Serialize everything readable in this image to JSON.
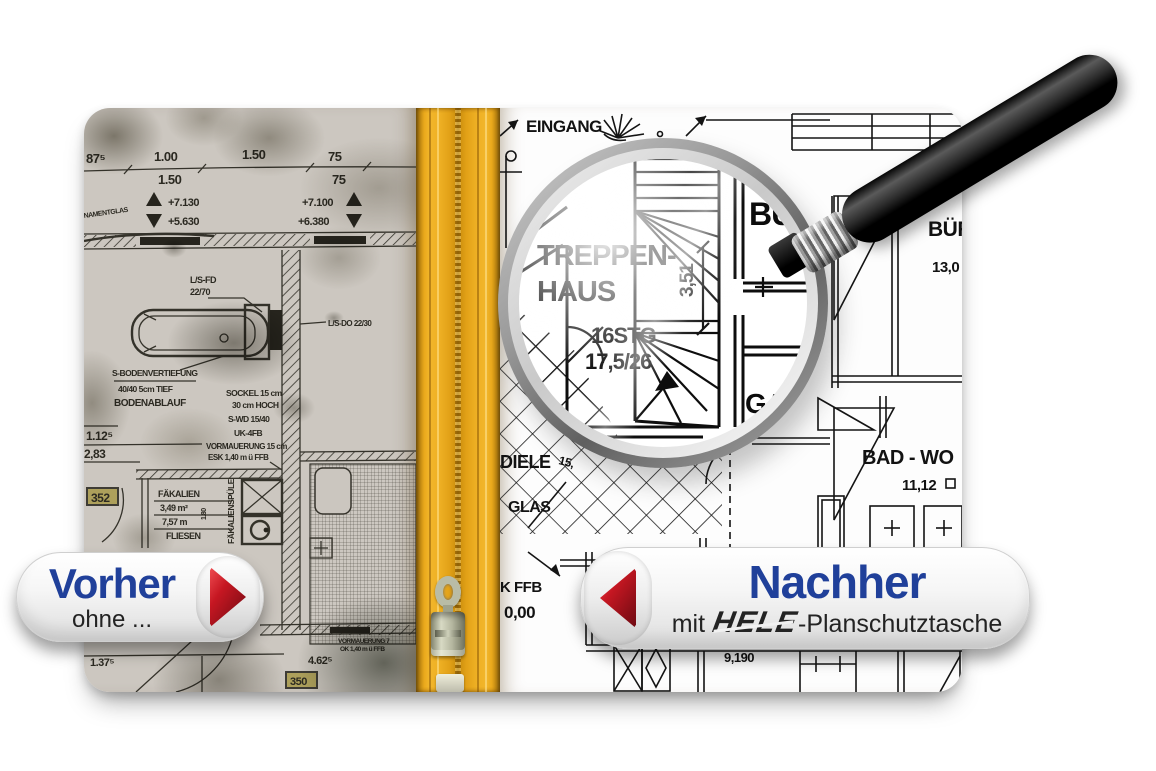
{
  "banners": {
    "before": {
      "title": "Vorher",
      "subtitle": "ohne ..."
    },
    "after": {
      "title": "Nachher",
      "prefix": "mit",
      "brand": "HELE",
      "suffix": "-Planschutztasche"
    }
  },
  "icons": {
    "before_arrow": "triangle-right",
    "after_arrow": "triangle-left",
    "magnifier": "magnifying-glass",
    "zipper": "zipper-fastener"
  },
  "colors": {
    "accent_blue": "#20409a",
    "arrow_red": "#c61722",
    "zipper_yellow": "#e8a81a",
    "dirty_plan_bg": "#ccc7c0"
  },
  "before_panel": {
    "dims": {
      "d875": "87⁵",
      "d100": "1.00",
      "d150a": "1.50",
      "d150b": "1.50",
      "d75a": "75",
      "d75b": "75"
    },
    "elevations": {
      "e1": "+7.130",
      "e2": "+5.630",
      "e3": "+7.100",
      "e4": "+6.380"
    },
    "labels": {
      "ornament": "NAMENTGLAS",
      "lsfd1": "L/S-FD",
      "lsfd2": "22/70",
      "lsdo": "L/S-DO 22/30",
      "sboden": "S-BODENVERTIEFUNG",
      "tief": "40/40 5cm TIEF",
      "ablauf": "BODENABLAUF",
      "sockel": "SOCKEL 15 cm",
      "hoch": "30 cm HOCH",
      "swd": "S-WD 15/40",
      "ukfb": "UK-4FB",
      "vorm": "VORMAUERUNG 15 cm",
      "esk": "ESK 1,40 m ü FFB",
      "v112": "1.12⁵",
      "v283": "2,83",
      "room_a": "352",
      "fak1": "FÄKALIEN",
      "fak2": "3,49 m²",
      "fak3": "7,57 m",
      "fak4": "FLIESEN",
      "spuele": "FÄKALIENSPÜLE",
      "h180": "1.80",
      "v137": "1.37⁵",
      "v462": "4.62⁵",
      "vorm2": "VORMAUERUNG 7",
      "ok140": "OK 1,40 m ü FFB",
      "room_b": "350"
    }
  },
  "after_panel": {
    "labels": {
      "eingang": "EINGANG",
      "buero": "BÜR",
      "b13": "13,0",
      "bad": "BAD - WO",
      "b1112": "11,12",
      "diele": "DIELE",
      "d15": "15,",
      "glas": "GLAS",
      "kffb": "K FFB",
      "nullnull": "0,00",
      "b919": "9,190"
    }
  },
  "magnifier": {
    "treppen": "TREPPEN-",
    "haus": "HAUS",
    "stg": "16STG",
    "steig": "17,5/26",
    "dim": "3,51",
    "bu": "BU",
    "gard": "GARD"
  }
}
